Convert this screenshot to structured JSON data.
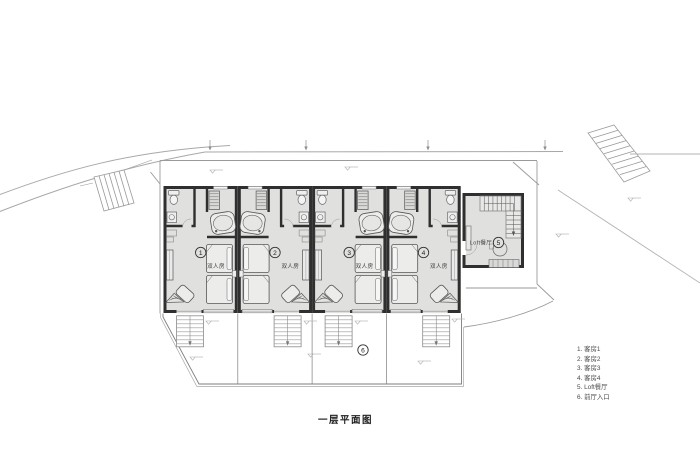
{
  "title": "一层平面图",
  "legend": {
    "items": [
      "1. 客房1",
      "2. 客房2",
      "3. 客房3",
      "4. 客房4",
      "5. Loft餐厅",
      "6. 前厅入口"
    ]
  },
  "plan": {
    "rooms": [
      {
        "number": "1",
        "label": "双人房"
      },
      {
        "number": "2",
        "label": "双人房"
      },
      {
        "number": "3",
        "label": "双人房"
      },
      {
        "number": "4",
        "label": "双人房"
      }
    ],
    "loft": {
      "number": "5",
      "label": "Loft餐厅"
    },
    "entry": {
      "number": "6"
    }
  },
  "colors": {
    "room_fill": "#e0e0df",
    "wall": "#2f2f2f",
    "furniture_line": "#5a5a5a",
    "site_line": "#a8a8a8",
    "background": "#ffffff"
  }
}
